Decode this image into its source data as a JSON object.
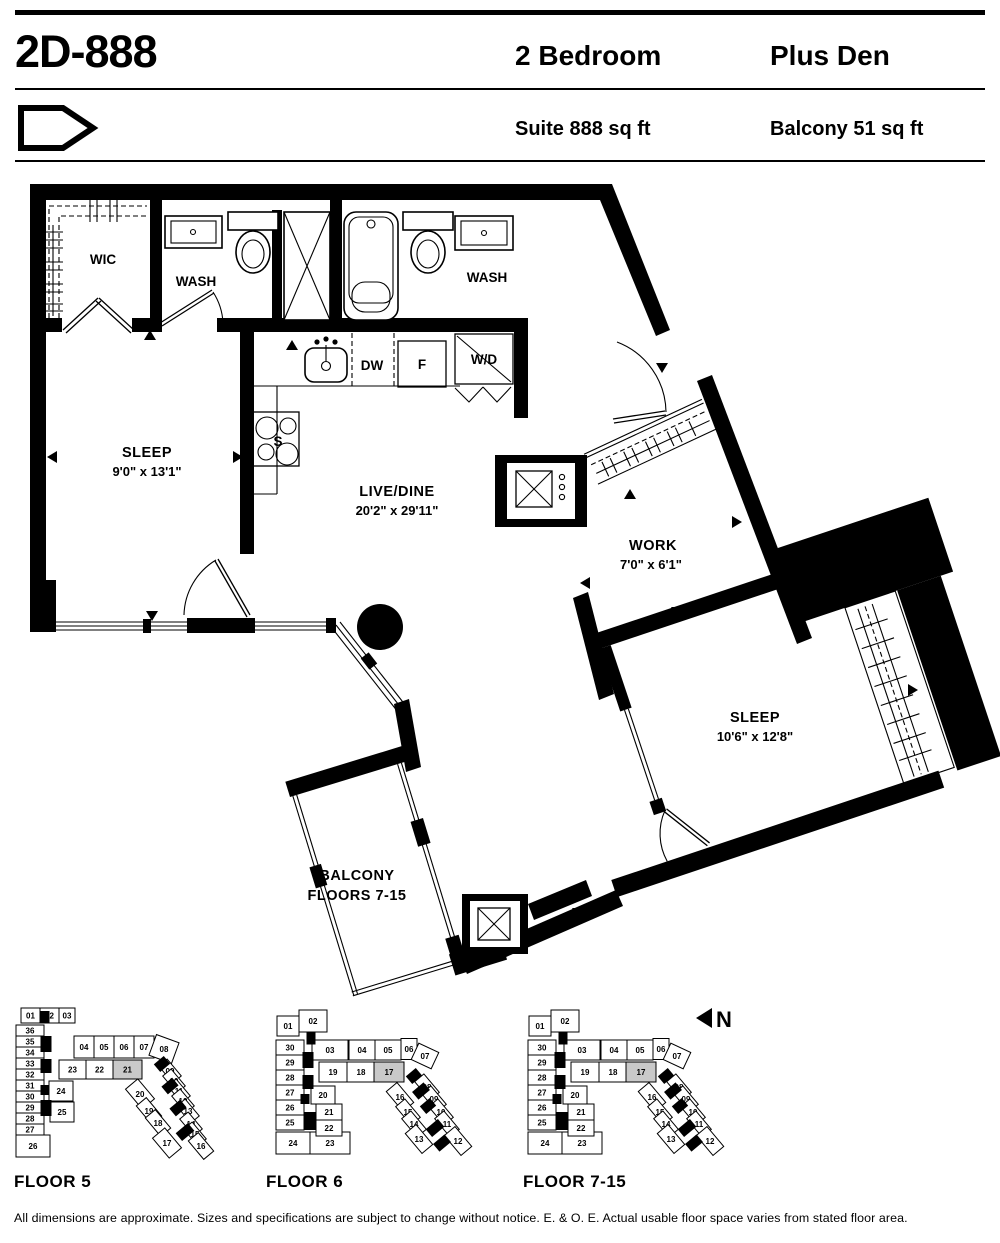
{
  "header": {
    "title": "2D-888",
    "type_line1": "2 Bedroom",
    "type_line2": "Plus Den",
    "suite_area": "Suite 888 sq ft",
    "balcony_area": "Balcony 51 sq ft"
  },
  "plan": {
    "rooms": {
      "wic": "WIC",
      "wash1": "WASH",
      "wash2": "WASH",
      "sleep1": {
        "name": "SLEEP",
        "dims": "9'0\" x 13'1\""
      },
      "livedine": {
        "name": "LIVE/DINE",
        "dims": "20'2\" x 29'11\""
      },
      "work": {
        "name": "WORK",
        "dims": "7'0\" x 6'1\""
      },
      "sleep2": {
        "name": "SLEEP",
        "dims": "10'6\" x 12'8\""
      },
      "balcony": {
        "line1": "BALCONY",
        "line2": "FLOORS 7-15"
      }
    },
    "appliances": {
      "dw": "DW",
      "fridge": "F",
      "wd": "W/D",
      "stove": "S"
    }
  },
  "north_label": "N",
  "keyplans": [
    {
      "label": "FLOOR 5",
      "highlight": "21",
      "units": [
        "01",
        "02",
        "03",
        "36",
        "35",
        "34",
        "33",
        "32",
        "31",
        "30",
        "29",
        "28",
        "27",
        "26",
        "04",
        "05",
        "06",
        "07",
        "08",
        "23",
        "22",
        "21",
        "24",
        "25",
        "20",
        "19",
        "18",
        "17",
        "09",
        "10",
        "11",
        "12",
        "13",
        "14",
        "15",
        "16"
      ]
    },
    {
      "label": "FLOOR 6",
      "highlight": "17",
      "units": [
        "01",
        "02",
        "30",
        "29",
        "28",
        "27",
        "26",
        "25",
        "24",
        "23",
        "03",
        "04",
        "05",
        "06",
        "07",
        "19",
        "18",
        "17",
        "20",
        "21",
        "22",
        "08",
        "09",
        "10",
        "11",
        "12",
        "16",
        "15",
        "14",
        "13"
      ]
    },
    {
      "label": "FLOOR 7-15",
      "highlight": "17",
      "units": [
        "01",
        "02",
        "30",
        "29",
        "28",
        "27",
        "26",
        "25",
        "24",
        "23",
        "03",
        "04",
        "05",
        "06",
        "07",
        "19",
        "18",
        "17",
        "20",
        "21",
        "22",
        "08",
        "09",
        "10",
        "11",
        "12",
        "16",
        "15",
        "14",
        "13"
      ]
    }
  ],
  "colors": {
    "highlight": "#c9c9c9",
    "wall": "#000000"
  },
  "disclaimer": "All dimensions are approximate. Sizes and specifications are subject to change without notice. E. & O. E. Actual usable floor space varies from stated floor area."
}
